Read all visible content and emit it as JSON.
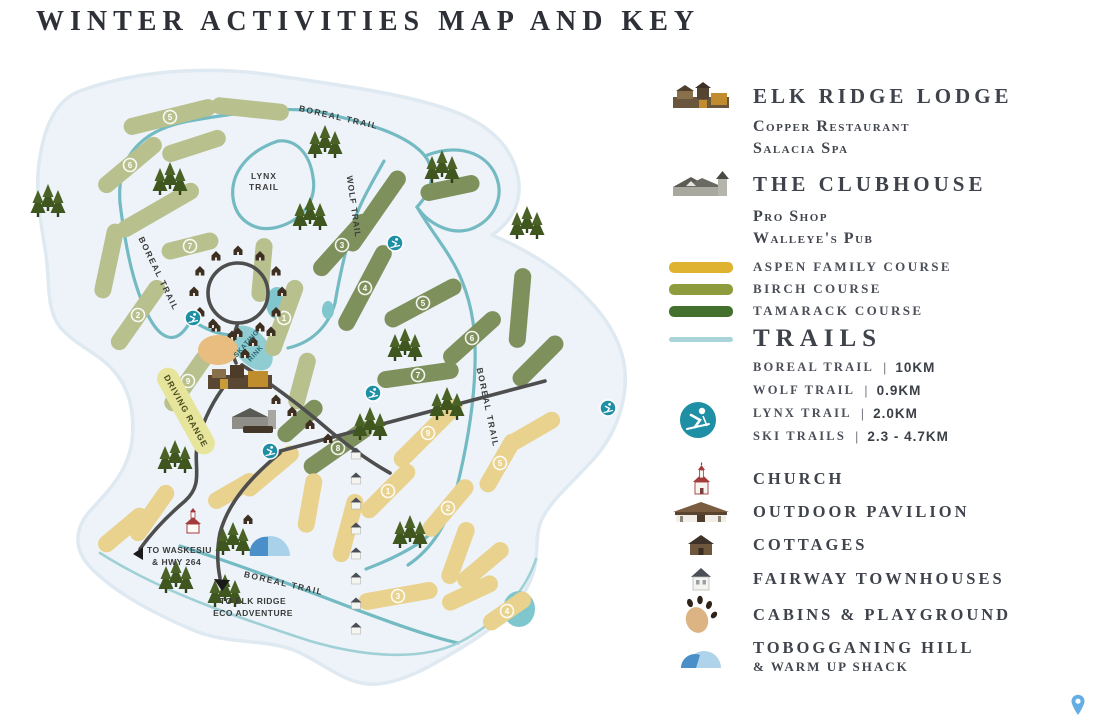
{
  "page": {
    "title": "WINTER ACTIVITIES MAP AND KEY"
  },
  "legend": {
    "lodge": {
      "heading": "ELK RIDGE LODGE",
      "sub1": "Copper Restaurant",
      "sub2": "Salacia Spa"
    },
    "clubhouse": {
      "heading": "THE CLUBHOUSE",
      "sub1": "Pro Shop",
      "sub2": "Walleye's Pub"
    },
    "courses": [
      {
        "label": "ASPEN FAMILY COURSE",
        "color": "#dfb22f"
      },
      {
        "label": "BIRCH COURSE",
        "color": "#8e9c3e"
      },
      {
        "label": "TAMARACK COURSE",
        "color": "#44702e"
      }
    ],
    "trails": {
      "heading": "TRAILS",
      "line_color": "#a9d4da",
      "items": [
        {
          "name": "BOREAL TRAIL",
          "distance": "10KM"
        },
        {
          "name": "WOLF TRAIL",
          "distance": "0.9KM"
        },
        {
          "name": "LYNX TRAIL",
          "distance": "2.0KM"
        },
        {
          "name": "SKI TRAILS",
          "distance": "2.3 - 4.7KM"
        }
      ]
    },
    "pois": [
      {
        "label": "CHURCH"
      },
      {
        "label": "OUTDOOR PAVILION"
      },
      {
        "label": "COTTAGES"
      },
      {
        "label": "FAIRWAY TOWNHOUSES"
      },
      {
        "label": "CABINS & PLAYGROUND"
      }
    ],
    "toboggan": {
      "heading": "TOBOGGANING HILL",
      "sub": "& WARM UP SHACK"
    }
  },
  "map": {
    "labels": {
      "boreal_top": "BOREAL TRAIL",
      "boreal_left": "BOREAL TRAIL",
      "boreal_right": "BOREAL TRAIL",
      "boreal_bottom": "BOREAL TRAIL",
      "lynx1": "LYNX",
      "lynx2": "TRAIL",
      "wolf": "WOLF TRAIL",
      "skating1": "SKATING",
      "skating2": "RINK",
      "driving": "DRIVING RANGE",
      "waskesiu1": "TO WASKESIU",
      "waskesiu2": "& HWY 264",
      "eco1": "TO ELK RIDGE",
      "eco2": "ECO ADVENTURE"
    },
    "colors": {
      "ground": "#edf3f8",
      "ground_edge": "#dfe9f1",
      "trail": "#74bac2",
      "trail_light": "#9fd0d6",
      "road": "#4e4e4e",
      "pond": "#7fc6cd",
      "marker": "#1f8fa6",
      "b": "#b8c08d",
      "t": "#7e915c",
      "a": "#e9d28d"
    },
    "fairways": [
      [
        190,
        124,
        95,
        -14,
        "b",
        "5"
      ],
      [
        270,
        116,
        78,
        6,
        "b",
        ""
      ],
      [
        150,
        172,
        78,
        -40,
        "b",
        "6"
      ],
      [
        214,
        153,
        66,
        -18,
        "b",
        ""
      ],
      [
        178,
        217,
        92,
        -30,
        "b",
        ""
      ],
      [
        129,
        268,
        76,
        -78,
        "b",
        ""
      ],
      [
        158,
        322,
        82,
        -55,
        "b",
        "2"
      ],
      [
        210,
        253,
        58,
        -14,
        "b",
        "7"
      ],
      [
        282,
        277,
        64,
        -85,
        "b",
        ""
      ],
      [
        304,
        325,
        80,
        -70,
        "b",
        "1"
      ],
      [
        208,
        388,
        70,
        -55,
        "b",
        "9"
      ],
      [
        322,
        388,
        58,
        -75,
        "b",
        ""
      ],
      [
        395,
        218,
        95,
        -55,
        "t",
        ""
      ],
      [
        362,
        252,
        78,
        -48,
        "t",
        "3"
      ],
      [
        385,
        295,
        95,
        -62,
        "t",
        "4"
      ],
      [
        443,
        310,
        85,
        -28,
        "t",
        "5"
      ],
      [
        492,
        345,
        72,
        -42,
        "t",
        "6"
      ],
      [
        438,
        382,
        82,
        -8,
        "t",
        "7"
      ],
      [
        540,
        315,
        80,
        -85,
        "t",
        ""
      ],
      [
        470,
        195,
        60,
        -12,
        "t",
        ""
      ],
      [
        558,
        368,
        65,
        -45,
        "t",
        ""
      ],
      [
        358,
        455,
        80,
        -35,
        "t",
        "8"
      ],
      [
        320,
        428,
        55,
        -42,
        "t",
        ""
      ],
      [
        448,
        440,
        90,
        -45,
        "a",
        "9"
      ],
      [
        368,
        535,
        70,
        -75,
        "a",
        ""
      ],
      [
        408,
        498,
        70,
        -45,
        "a",
        "1"
      ],
      [
        468,
        515,
        70,
        -50,
        "a",
        "2"
      ],
      [
        418,
        603,
        80,
        -10,
        "a",
        "3"
      ],
      [
        478,
        560,
        65,
        -70,
        "a",
        ""
      ],
      [
        503,
        572,
        62,
        -40,
        "a",
        ""
      ],
      [
        527,
        618,
        55,
        -35,
        "a",
        "4"
      ],
      [
        490,
        600,
        60,
        -25,
        "a",
        ""
      ],
      [
        143,
        537,
        60,
        -40,
        "a",
        ""
      ],
      [
        172,
        520,
        65,
        -55,
        "a",
        ""
      ],
      [
        290,
        478,
        70,
        -40,
        "a",
        ""
      ],
      [
        330,
        510,
        60,
        -80,
        "a",
        ""
      ],
      [
        520,
        470,
        65,
        -60,
        "a",
        "5"
      ],
      [
        553,
        438,
        60,
        -30,
        "a",
        ""
      ],
      [
        253,
        498,
        55,
        -30,
        "a",
        ""
      ]
    ],
    "trees": [
      [
        68,
        214
      ],
      [
        190,
        192
      ],
      [
        345,
        155
      ],
      [
        462,
        180
      ],
      [
        330,
        227
      ],
      [
        547,
        236
      ],
      [
        195,
        470
      ],
      [
        425,
        358
      ],
      [
        467,
        417
      ],
      [
        430,
        545
      ],
      [
        253,
        552
      ],
      [
        196,
        590
      ],
      [
        245,
        604
      ],
      [
        390,
        437
      ]
    ],
    "markers": [
      [
        213,
        325
      ],
      [
        393,
        400
      ],
      [
        290,
        458
      ],
      [
        628,
        415
      ],
      [
        415,
        250
      ]
    ]
  }
}
